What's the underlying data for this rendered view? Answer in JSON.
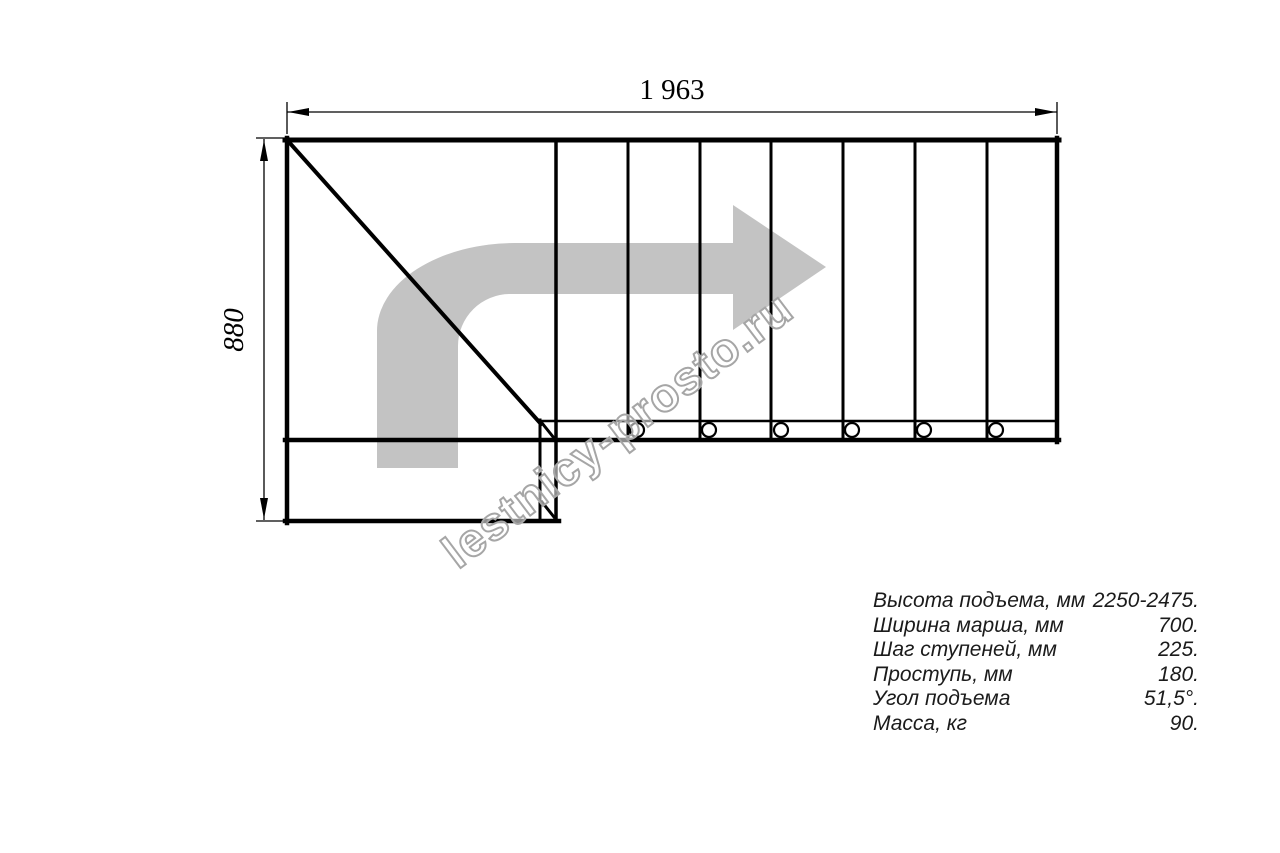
{
  "drawing": {
    "width_dimension_label": "1 963",
    "height_dimension_label": "880",
    "watermark": "lestnicy-prosto.ru"
  },
  "specs": {
    "rows": [
      {
        "label": "Высота подъема, мм",
        "value": "2250-2475."
      },
      {
        "label": "Ширина марша, мм",
        "value": "700."
      },
      {
        "label": "Шаг ступеней, мм",
        "value": "225."
      },
      {
        "label": "Проступь, мм",
        "value": "180."
      },
      {
        "label": "Угол подъема",
        "value": "51,5°."
      },
      {
        "label": "Масса, кг",
        "value": "90."
      }
    ]
  },
  "colors": {
    "line": "#000000",
    "direction_arrow": "#c3c3c3",
    "watermark_outline": "#a6a6a6",
    "spec_text": "#1b1b1b",
    "background": "#ffffff"
  }
}
